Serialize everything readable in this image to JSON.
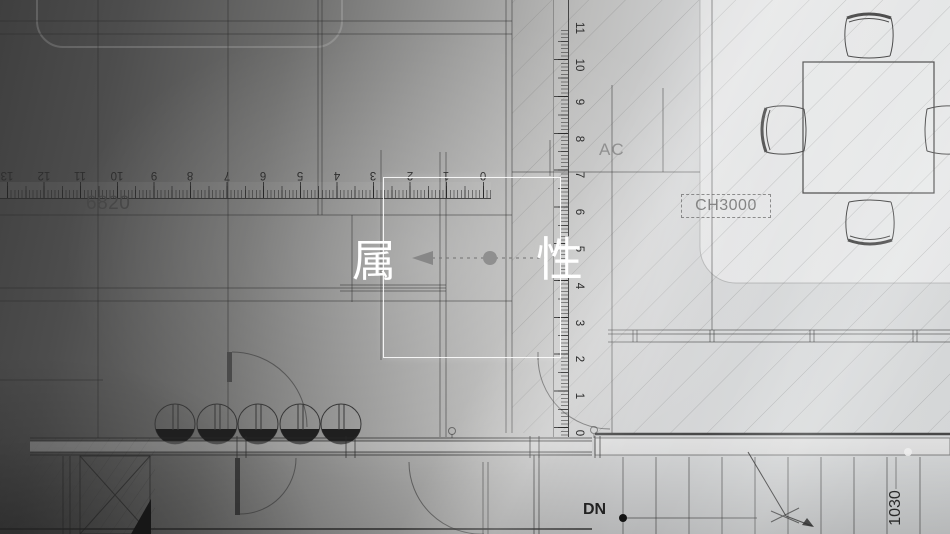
{
  "scene": {
    "description": "architectural CAD blueprint banner",
    "title_chars": {
      "left": "属",
      "right": "性"
    }
  },
  "annotations": {
    "dim_horizontal": "6820",
    "room_label": "AC",
    "item_label": "CH3000",
    "stair_label": "DN",
    "dim_stair": "1030"
  },
  "rulers": {
    "horizontal": {
      "values": [
        13,
        12,
        11,
        10,
        9,
        8,
        7,
        6,
        5,
        4,
        3,
        2,
        1,
        0
      ],
      "zero_x": 483,
      "unit_px": 36.6,
      "center_y": 174
    },
    "vertical": {
      "values": [
        11,
        10,
        9,
        8,
        7,
        6,
        5,
        4,
        3,
        2,
        1,
        0
      ],
      "zero_y": 433,
      "unit_px": 36.8,
      "center_x": 578
    }
  },
  "colors": {
    "ink": "#3a3a3a",
    "white": "#ffffff",
    "label_gray": "#848484",
    "bg_dark": "#3f3f3f",
    "bg_light": "#d9dbdc",
    "planter_fill": "#1f1f1f"
  }
}
